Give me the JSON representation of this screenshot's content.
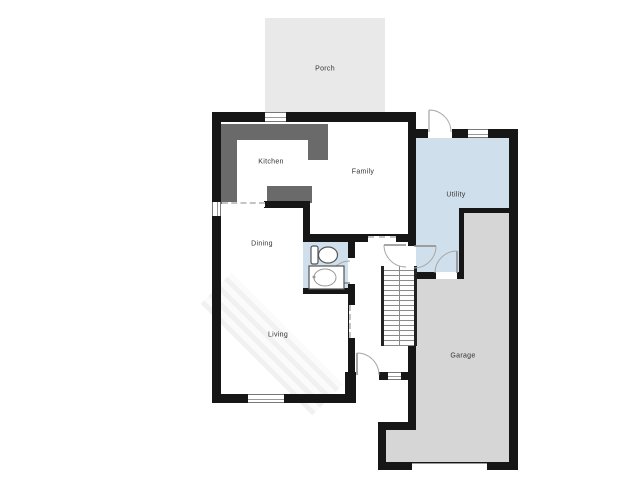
{
  "floor_plan": {
    "title": "First floor plan",
    "rooms": [
      {
        "name": "Porch"
      },
      {
        "name": "Kitchen"
      },
      {
        "name": "Family"
      },
      {
        "name": "Utility"
      },
      {
        "name": "Dining"
      },
      {
        "name": "Living"
      },
      {
        "name": "Garage"
      }
    ],
    "fixtures": [
      "toilet",
      "sink",
      "staircase"
    ],
    "colors": {
      "background": "#ffffff",
      "wall": "#161616",
      "porch_fill": "#e9e9e9",
      "wet_room_fill": "#cfdfeb",
      "garage_fill": "#d6d6d6",
      "counter_fill": "#6a6a6a",
      "door_arc": "#a8a8a8"
    }
  }
}
